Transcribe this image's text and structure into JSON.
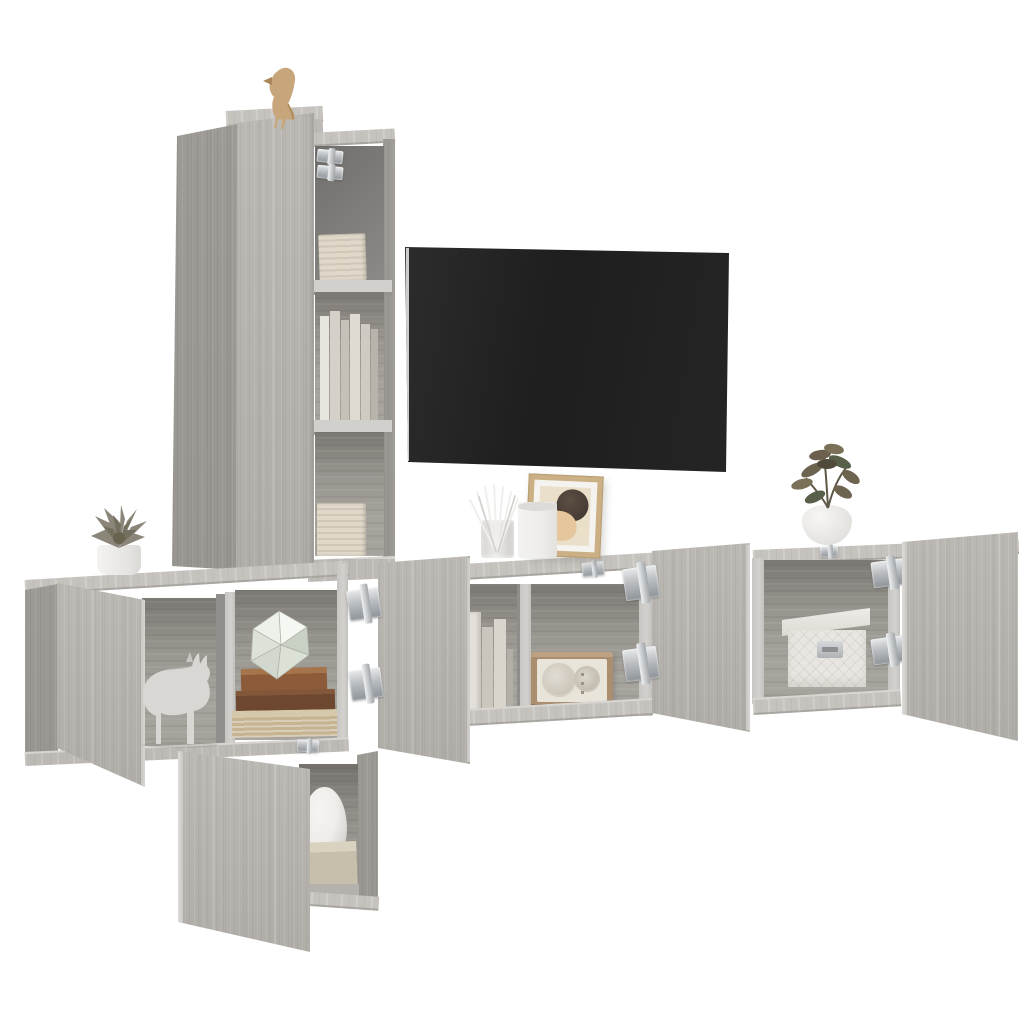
{
  "meta": {
    "description": "Product photograph of a 5-piece grey sonoma oak wall-mounted TV cabinet set on a white background, doors open showing decor",
    "finish": "grey sonoma oak woodgrain"
  },
  "palette": {
    "background": "#ffffff",
    "wood_face": "#b8b5b0",
    "wood_face_dark": "#a6a39e",
    "wood_top": "#c6c3be",
    "wood_back": "#a29e98",
    "wood_edge": "#d3d1cd",
    "wood_interior_dark": "#716f6b",
    "tv_screen": "#222222",
    "metal_hinge": "#b0b4b8",
    "book_cream": "#d9d2c2",
    "book_brown": "#8c5c3a",
    "book_dark_brown": "#6d4730",
    "book_beige": "#c5b391",
    "figurine_gold": "#c7a67c",
    "figurine_white": "#d9d7d3",
    "plant_olive": "#6d6450",
    "succulent_grey": "#8b8679",
    "pot_white": "#f2f1ef",
    "radio_wood": "#a98f70",
    "radio_face": "#e9e4da",
    "box_white": "#e9e6e1",
    "frame_tan": "#cbb085",
    "art_peach": "#e6c69c",
    "art_dark": "#3e352d",
    "vase_white": "#eeedea"
  },
  "scene": {
    "tv": {
      "name": "wall-mounted flat-screen TV",
      "state": "off"
    },
    "furniture": [
      {
        "name": "tall wall shelf cabinet",
        "position": "left",
        "contents": [
          "mounting hinges",
          "book stacks",
          "upright books"
        ]
      },
      {
        "name": "cube wall cabinet",
        "position": "mid-left",
        "state": "door open",
        "contents": [
          "origami rhino figurine",
          "geometric ornament",
          "stacked books"
        ]
      },
      {
        "name": "lower cube wall cabinet",
        "position": "bottom-left",
        "state": "door open",
        "contents": [
          "round vase",
          "storage box"
        ]
      },
      {
        "name": "wide TV wall cabinet",
        "position": "center",
        "state": "both doors open",
        "contents": [
          "upright folders",
          "vintage radio"
        ]
      },
      {
        "name": "wide wall cabinet",
        "position": "right",
        "state": "doors open",
        "contents": [
          "quilted storage box"
        ]
      }
    ],
    "decor": [
      "gold bird figurine",
      "succulent in white pot",
      "reed diffuser",
      "white pillar candle",
      "framed abstract art",
      "leafy plant in white pot"
    ]
  }
}
